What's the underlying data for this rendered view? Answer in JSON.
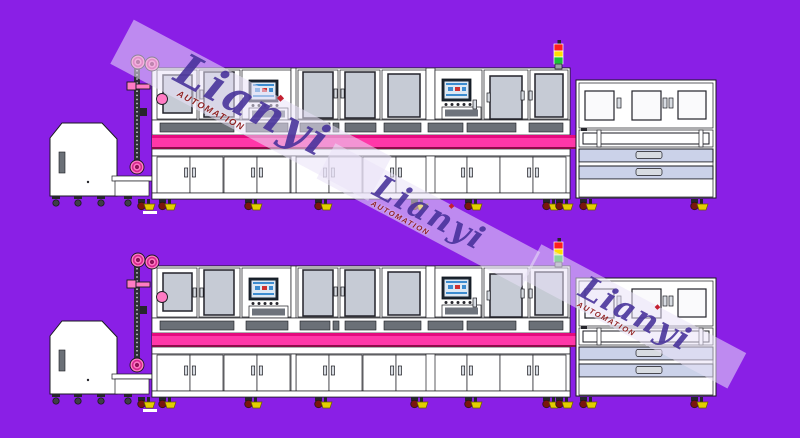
{
  "background_color": "#8A1FE6",
  "watermark": {
    "brand": "Lianyi",
    "subtitle": "AUTOMATION",
    "instances": 3
  },
  "colors": {
    "bg": "#8A1FE6",
    "ink": "#1A1A20",
    "body": "#FFFFFF",
    "window": "#C6CBD5",
    "window-frame": "#23232B",
    "window-light": "#FAFAFC",
    "slot": "#6B7077",
    "conveyor": "#FF37A8",
    "conveyor-top": "#E40A7E",
    "conveyor-edge": "#8F0C49",
    "pink": "#FF7BC4",
    "pink-ring": "#D6268E",
    "pink-core": "#8C1458",
    "wheel": "#7A150E",
    "foot": "#E3CE00",
    "screen": "#DCE8F4",
    "screen-frame": "#1B2530",
    "screen-accent": "#3C8CD0",
    "tray": "#6E737C",
    "drawer": "#CBD2E9",
    "handle": "#D8DCE2",
    "sig-red": "#FF1E1E",
    "sig-yellow": "#FFDD00",
    "sig-green": "#17C437",
    "wm-band": "rgba(233,225,248,0.55)",
    "wm-brand": "#46309A",
    "wm-sub": "#8C1A1A"
  },
  "machines": [
    {
      "id": "assembly-line-top"
    },
    {
      "id": "assembly-line-bottom"
    }
  ],
  "components": [
    "infeed-feeder",
    "chain-elevator",
    "process-module-1",
    "process-module-2",
    "process-module-3",
    "hmi-panel-1",
    "hmi-panel-2",
    "transfer-conveyor",
    "lower-cabinets",
    "outfeed-cabinet",
    "signal-tower",
    "casters"
  ]
}
